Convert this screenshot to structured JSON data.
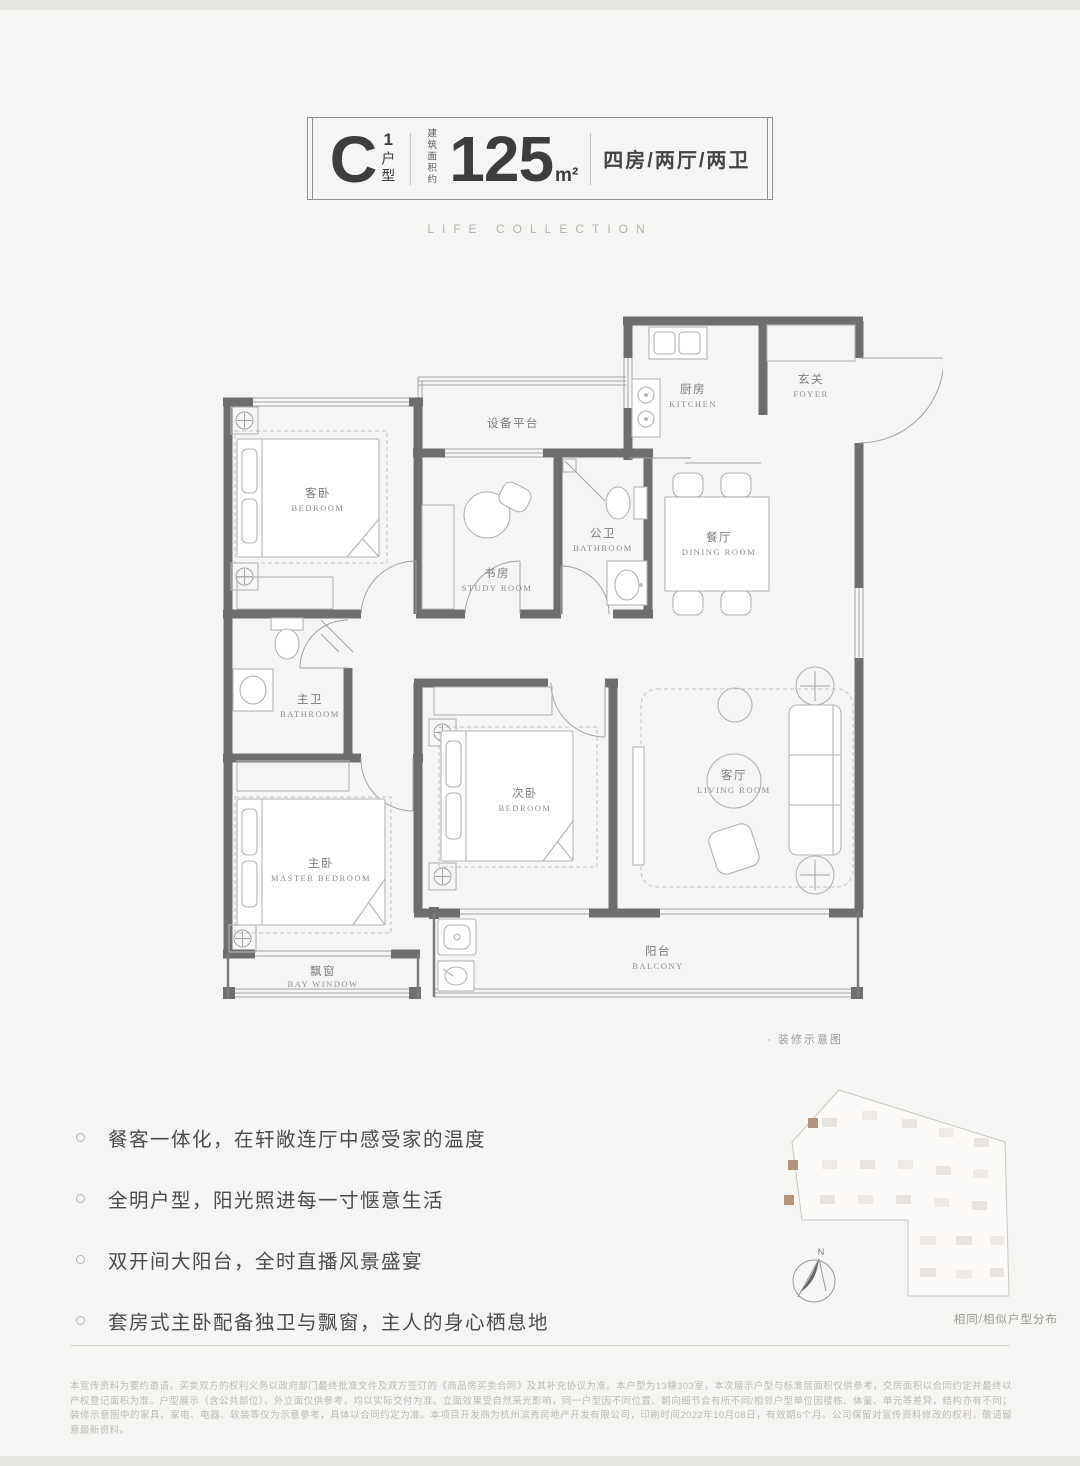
{
  "header": {
    "unit_letter": "C",
    "unit_sup": "1",
    "unit_suffix": "户型",
    "area_label": "建筑面积约",
    "area_value": "125",
    "area_unit": "m²",
    "layout": "四房/两厅/两卫"
  },
  "subtitle": "LIFE COLLECTION",
  "floorplan": {
    "caption": "· 装修示意图",
    "equipment_platform": "设备平台",
    "rooms": {
      "guest_bedroom": {
        "cn": "客卧",
        "en": "BEDROOM"
      },
      "study": {
        "cn": "书房",
        "en": "STUDY ROOM"
      },
      "public_bath": {
        "cn": "公卫",
        "en": "BATHROOM"
      },
      "kitchen": {
        "cn": "厨房",
        "en": "KITCHEN"
      },
      "foyer": {
        "cn": "玄关",
        "en": "FOYER"
      },
      "dining": {
        "cn": "餐厅",
        "en": "DINING ROOM"
      },
      "master_bath": {
        "cn": "主卫",
        "en": "BATHROOM"
      },
      "master_bedroom": {
        "cn": "主卧",
        "en": "MASTER BEDROOM"
      },
      "second_bedroom": {
        "cn": "次卧",
        "en": "BEDROOM"
      },
      "living": {
        "cn": "客厅",
        "en": "LIVING ROOM"
      },
      "balcony": {
        "cn": "阳台",
        "en": "BALCONY"
      },
      "bay_window": {
        "cn": "飘窗",
        "en": "BAY WINDOW"
      }
    }
  },
  "features": [
    "餐客一体化，在轩敞连厅中感受家的温度",
    "全明户型，阳光照进每一寸惬意生活",
    "双开间大阳台，全时直播风景盛宴",
    "套房式主卧配备独卫与飘窗，主人的身心栖息地"
  ],
  "sitemap": {
    "label": "相同/相似户型分布",
    "compass": "N",
    "highlight_color": "#b1947c"
  },
  "disclaimer": "本宣传资料为要约邀请，买卖双方的权利义务以政府部门最终批准文件及双方签订的《商品房买卖合同》及其补充协议为准。本户型为13幢303室，本次展示户型与标准层面积仅供参考，交房面积以合同约定并最终以产权登记面积为准。户型展示（含公共部位）、外立面仅供参考，均以实际交付为准。立面效果受自然采光影响，同一户型因不同位置、朝向细节会有所不同/相邻户型单位因楼栋、体量、单元等差异，结构亦有不同；装修示意图中的家具、家电、电器、软装等仅为示意参考，具体以合同约定为准。本项目开发商为杭州滨秀房地产开发有限公司，印刷时间2022年10月08日，有效期6个月。公司保留对宣传资料修改的权利，敬请留意最新资料。"
}
